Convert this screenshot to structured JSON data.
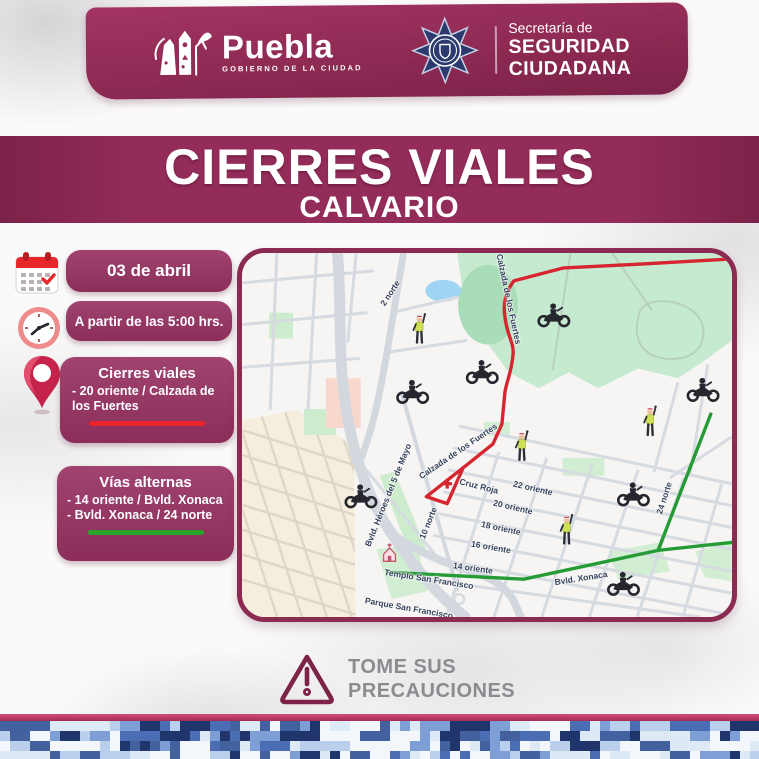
{
  "header": {
    "puebla": {
      "wordmark": "Puebla",
      "tagline": "GOBIERNO DE LA CIUDAD"
    },
    "secretaria": {
      "line1": "Secretaría de",
      "line2": "SEGURIDAD",
      "line3": "CIUDADANA"
    }
  },
  "title": {
    "main": "CIERRES VIALES",
    "sub": "CALVARIO"
  },
  "info_panel": {
    "date_label": "03 de abril",
    "time_label": "A partir de las 5:00 hrs.",
    "closures": {
      "title": "Cierres viales",
      "item": "- 20 oriente / Calzada de los Fuertes"
    },
    "alternates": {
      "title": "Vías alternas",
      "item1": "- 14 oriente / Bvld. Xonaca",
      "item2": "- Bvld. Xonaca / 24 norte"
    }
  },
  "map": {
    "closed_route": "Calzada de los Fuertes",
    "street_labels": [
      {
        "text": "2 norte",
        "x": 148,
        "y": 40,
        "rot": -57
      },
      {
        "text": "Calzada de los Fuertes",
        "x": 267,
        "y": 46,
        "rot": 78
      },
      {
        "text": "Calzada de los Fuertes",
        "x": 216,
        "y": 198,
        "rot": -34
      },
      {
        "text": "Cruz Roja",
        "x": 237,
        "y": 233,
        "rot": 14
      },
      {
        "text": "22 oriente",
        "x": 291,
        "y": 235,
        "rot": 13
      },
      {
        "text": "20 oriente",
        "x": 271,
        "y": 254,
        "rot": 13
      },
      {
        "text": "18 oriente",
        "x": 259,
        "y": 275,
        "rot": 12
      },
      {
        "text": "16 oriente",
        "x": 249,
        "y": 294,
        "rot": 10
      },
      {
        "text": "14 oriente",
        "x": 231,
        "y": 315,
        "rot": 8
      },
      {
        "text": "Bvld. Xonaca",
        "x": 339,
        "y": 325,
        "rot": -9
      },
      {
        "text": "24 norte",
        "x": 422,
        "y": 245,
        "rot": -72
      },
      {
        "text": "Bvld. Héroes del 5 de Mayo",
        "x": 146,
        "y": 242,
        "rot": -68
      },
      {
        "text": "10 norte",
        "x": 186,
        "y": 270,
        "rot": -68
      },
      {
        "text": "Templo San Francisco",
        "x": 187,
        "y": 326,
        "rot": 9
      },
      {
        "text": "Parque San Francisco",
        "x": 167,
        "y": 355,
        "rot": 10
      }
    ],
    "markers": [
      {
        "type": "officer",
        "x": 178,
        "y": 77
      },
      {
        "type": "officer",
        "x": 281,
        "y": 195
      },
      {
        "type": "officer",
        "x": 326,
        "y": 279
      },
      {
        "type": "officer",
        "x": 410,
        "y": 170
      },
      {
        "type": "moto",
        "x": 313,
        "y": 62
      },
      {
        "type": "moto",
        "x": 241,
        "y": 119
      },
      {
        "type": "moto",
        "x": 171,
        "y": 139
      },
      {
        "type": "moto",
        "x": 463,
        "y": 137
      },
      {
        "type": "moto",
        "x": 393,
        "y": 242
      },
      {
        "type": "moto",
        "x": 383,
        "y": 332
      },
      {
        "type": "moto",
        "x": 119,
        "y": 244
      }
    ],
    "pois": [
      {
        "type": "redcross",
        "x": 206,
        "y": 232
      },
      {
        "type": "church",
        "x": 148,
        "y": 301
      }
    ]
  },
  "footer": {
    "warning_line1": "TOME SUS",
    "warning_line2": "PRECAUCIONES"
  },
  "colors": {
    "accent": "#8c2b52",
    "closure_line": "#e8252d",
    "alternate_line": "#28a42c",
    "camo": [
      "#20356b",
      "#44619f",
      "#4a6db4",
      "#7e9ed6",
      "#b9cfeb",
      "#dde9f5",
      "#f3f7fb"
    ]
  }
}
